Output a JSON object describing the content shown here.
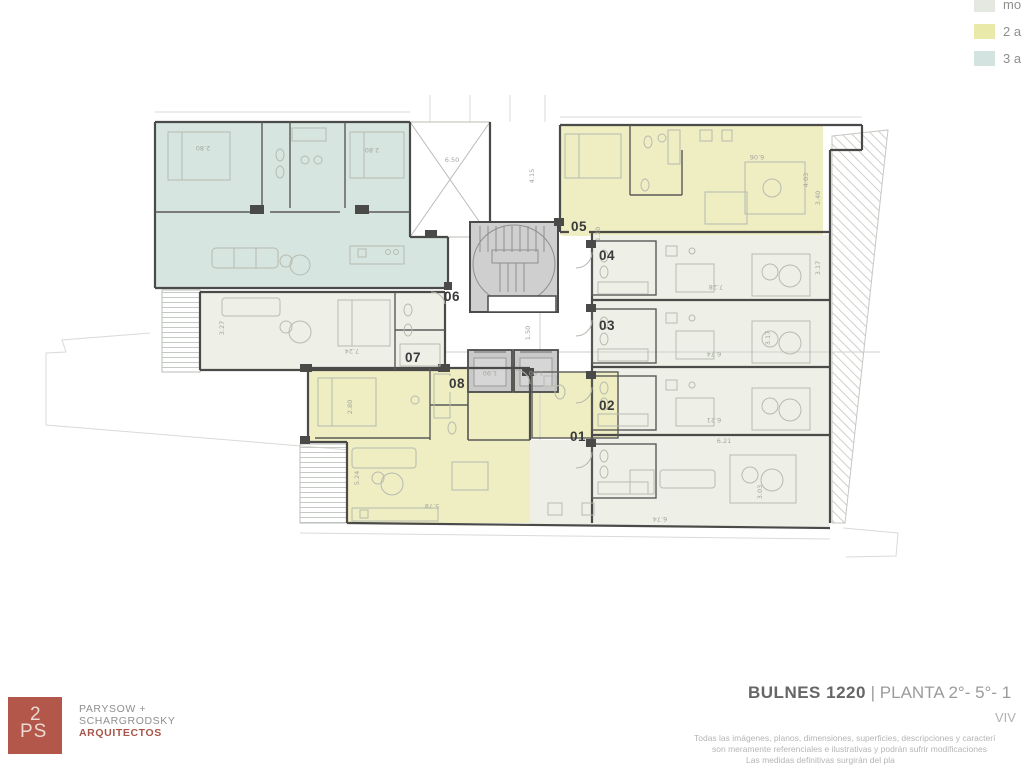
{
  "legend": {
    "items": [
      {
        "label": "mo",
        "color": "#e4e8e1"
      },
      {
        "label": "2 a",
        "color": "#e9e9a9"
      },
      {
        "label": "3 a",
        "color": "#d3e3e0"
      }
    ]
  },
  "plan": {
    "unit_labels": [
      {
        "text": "01",
        "x": 578,
        "y": 437,
        "bg": "none"
      },
      {
        "text": "02",
        "x": 607,
        "y": 406,
        "bg": "none"
      },
      {
        "text": "03",
        "x": 607,
        "y": 326,
        "bg": "none"
      },
      {
        "text": "04",
        "x": 607,
        "y": 256,
        "bg": "none"
      },
      {
        "text": "05",
        "x": 579,
        "y": 227,
        "bg": "yellow"
      },
      {
        "text": "06",
        "x": 452,
        "y": 297,
        "bg": "none"
      },
      {
        "text": "07",
        "x": 413,
        "y": 358,
        "bg": "none"
      },
      {
        "text": "08",
        "x": 457,
        "y": 384,
        "bg": "yellow"
      }
    ],
    "dimensions": [
      {
        "text": "2.80",
        "x": 203,
        "y": 148,
        "rot": 180
      },
      {
        "text": "2.80",
        "x": 372,
        "y": 150,
        "rot": 180
      },
      {
        "text": "6.50",
        "x": 452,
        "y": 160,
        "rot": 0
      },
      {
        "text": "4.15",
        "x": 532,
        "y": 176,
        "rot": -90
      },
      {
        "text": "6.06",
        "x": 757,
        "y": 157,
        "rot": 180
      },
      {
        "text": "4.03",
        "x": 806,
        "y": 180,
        "rot": -90
      },
      {
        "text": "3.40",
        "x": 818,
        "y": 198,
        "rot": -90
      },
      {
        "text": "1.20",
        "x": 598,
        "y": 234,
        "rot": -90
      },
      {
        "text": "7.28",
        "x": 716,
        "y": 287,
        "rot": 180
      },
      {
        "text": "3.17",
        "x": 818,
        "y": 268,
        "rot": -90
      },
      {
        "text": "6.74",
        "x": 714,
        "y": 354,
        "rot": 180
      },
      {
        "text": "3.17",
        "x": 768,
        "y": 338,
        "rot": -90
      },
      {
        "text": "6.21",
        "x": 714,
        "y": 420,
        "rot": 180
      },
      {
        "text": "6.21",
        "x": 724,
        "y": 441,
        "rot": 0
      },
      {
        "text": "3.03",
        "x": 760,
        "y": 492,
        "rot": -90
      },
      {
        "text": "1.50",
        "x": 528,
        "y": 333,
        "rot": -90
      },
      {
        "text": "3.27",
        "x": 222,
        "y": 328,
        "rot": -90
      },
      {
        "text": "7.24",
        "x": 352,
        "y": 351,
        "rot": 180
      },
      {
        "text": "2.80",
        "x": 350,
        "y": 407,
        "rot": -90
      },
      {
        "text": "5.24",
        "x": 357,
        "y": 478,
        "rot": -90
      },
      {
        "text": "5.78",
        "x": 432,
        "y": 506,
        "rot": 180
      },
      {
        "text": "6.74",
        "x": 660,
        "y": 519,
        "rot": 180
      },
      {
        "text": "1.90",
        "x": 490,
        "y": 373,
        "rot": 180
      },
      {
        "text": "1.90",
        "x": 536,
        "y": 373,
        "rot": 180
      }
    ]
  },
  "footer": {
    "logo_line1": "2",
    "logo_line2": "PS",
    "firm_line1": "PARYSOW +",
    "firm_line2": "SCHARGRODSKY",
    "firm_line3": "ARQUITECTOS",
    "title_bold": "BULNES 1220",
    "title_rest": " | PLANTA 2°- 5°- 1",
    "subtitle": "VIV",
    "disclaimer_line1": "Todas las imágenes, planos, dimensiones, superficies, descripciones y caracterí",
    "disclaimer_line2": "son meramente referenciales e ilustrativas y podrán sufrir modificaciones",
    "disclaimer_line3": "Las medidas definitivas surgirán del pla"
  },
  "colors": {
    "mono_fill": "#eef0e7",
    "two_amb_fill": "#efedc2",
    "three_amb_fill": "#d6e5e0",
    "core_fill": "#cfcfcf",
    "brand_red": "#b2574a"
  }
}
